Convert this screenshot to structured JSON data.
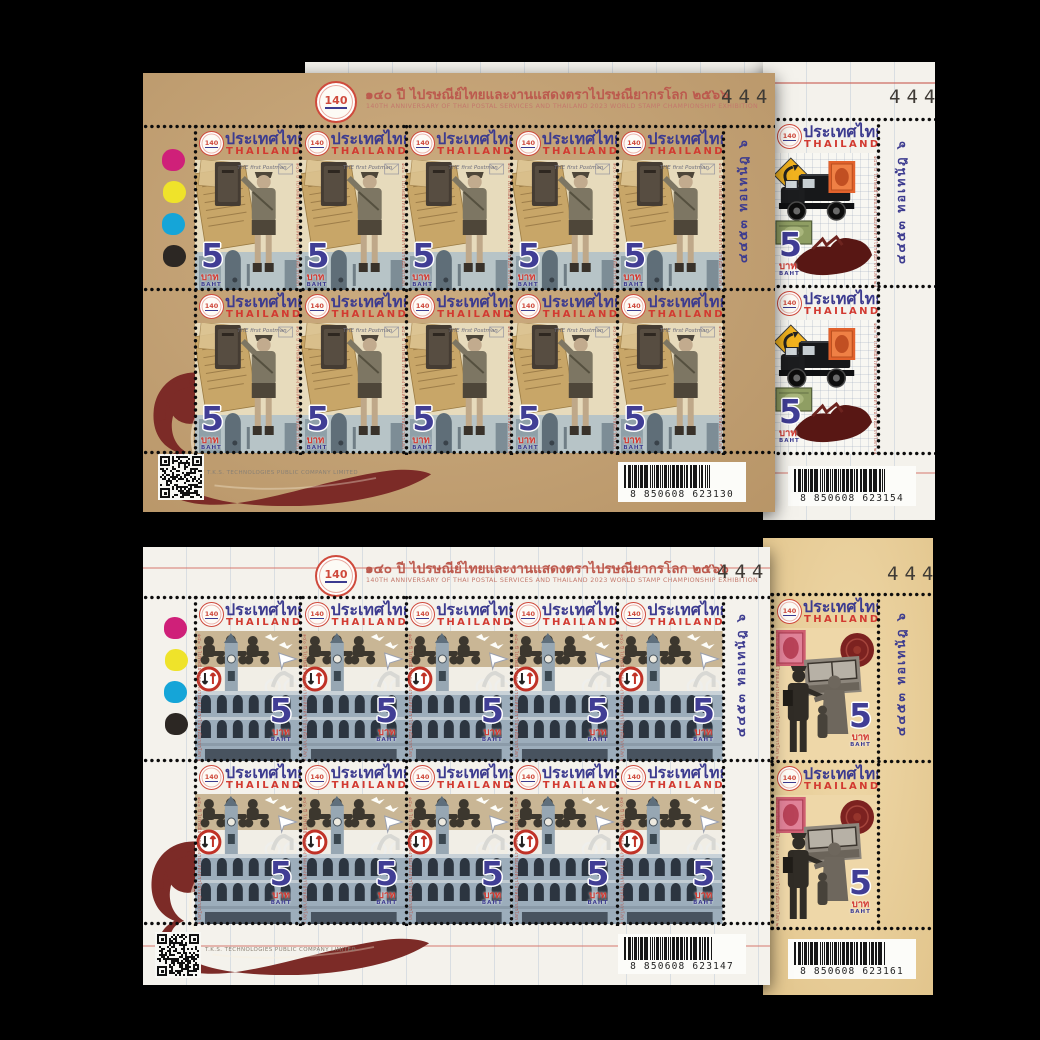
{
  "header": {
    "title_thai": "๑๔๐ ปี ไปรษณีย์ไทยและงานแสดงตราไปรษณียากรโลก ๒๕๖๖",
    "title_english": "140TH ANNIVERSARY OF THAI POSTAL SERVICES AND THAILAND 2023 WORLD STAMP CHAMPIONSHIP EXHIBITION"
  },
  "anniversary_logo": {
    "text": "140"
  },
  "stamp": {
    "country_thai": "ประเทศไทย",
    "country_english": "THAILAND",
    "value": "5",
    "currency_thai": "บาท",
    "currency_english": "BAHT",
    "postman_caption": "THE first Postman",
    "micro_text": "๑๔๐ ปี ไปรษณีย์ไทยและงานแสดงตราไปรษณียากรโลก ๒๕๖๖"
  },
  "margin": {
    "plate_text": "๔๔๕๓ ทอเทนัฎ ๖",
    "printer": "T.K.S. TECHNOLOGIES PUBLIC COMPANY LIMITED"
  },
  "sheets": {
    "top_front": {
      "number": "444",
      "barcode": "8850608623130",
      "barcode_display": "8 850608 623130"
    },
    "top_back": {
      "number": "444",
      "barcode": "8850608623154",
      "barcode_display": "8 850608 623154"
    },
    "bottom_front": {
      "number": "444",
      "barcode": "8850608623147",
      "barcode_display": "8 850608 623147"
    },
    "bottom_back": {
      "number": "444",
      "barcode": "8850608623161",
      "barcode_display": "8 850608 623161"
    }
  }
}
